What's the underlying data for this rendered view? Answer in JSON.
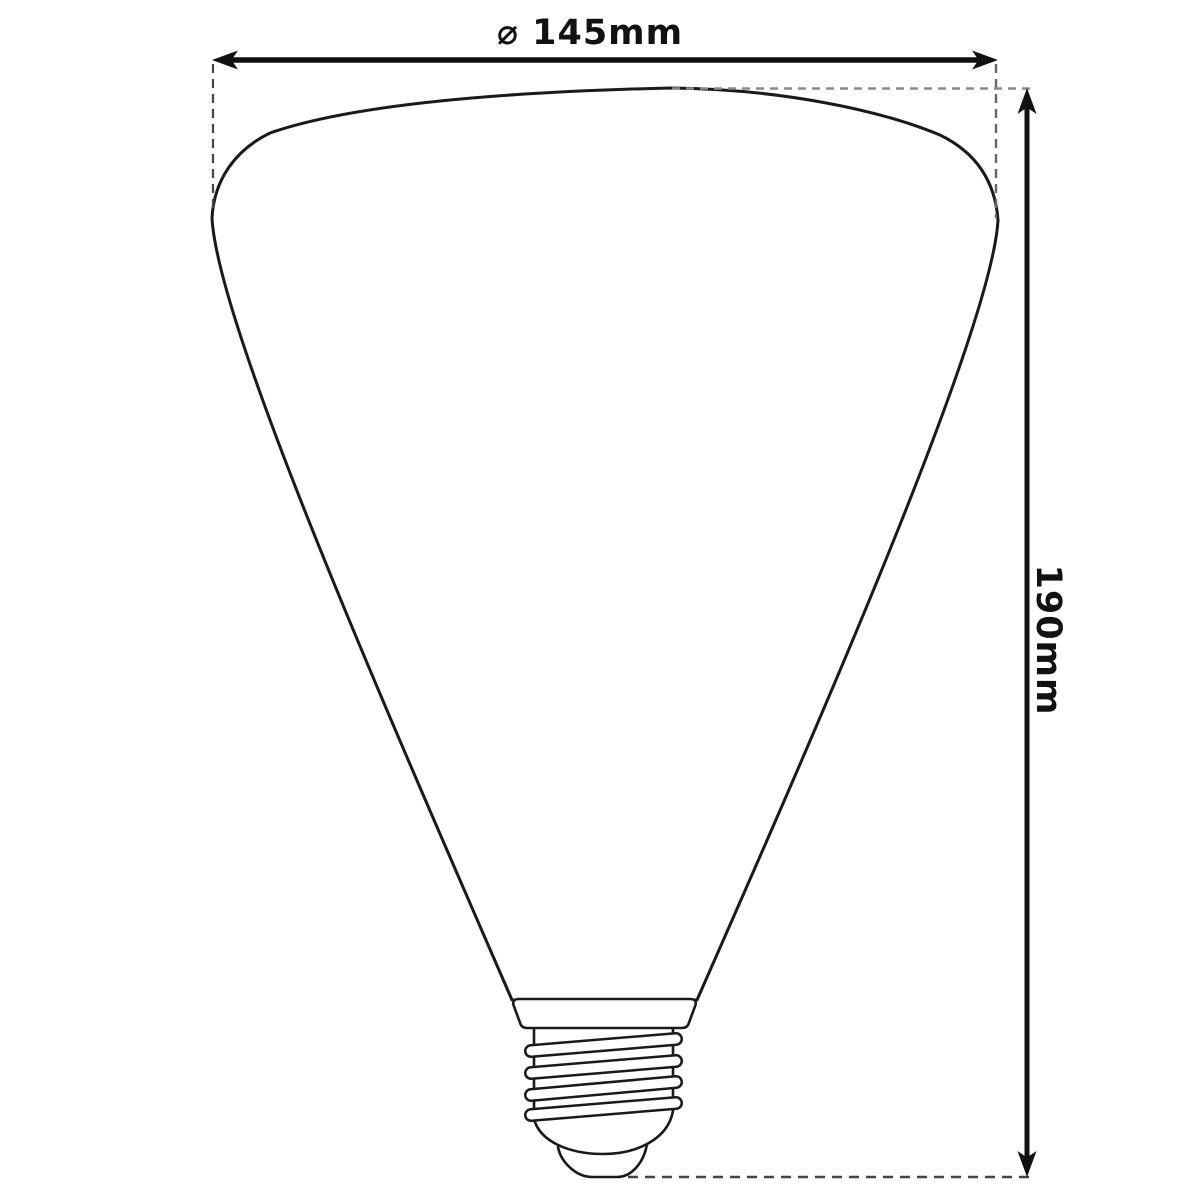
{
  "diagram": {
    "width_dimension": {
      "label": "⌀ 145mm"
    },
    "height_dimension": {
      "label": "190mm"
    },
    "colors": {
      "outline": "#1a1a1a",
      "dimension_lines": "#111111",
      "dash_dark": "#444444",
      "dash_mid": "#666666",
      "dash_light": "#8a8a8a",
      "background": "#ffffff"
    }
  }
}
